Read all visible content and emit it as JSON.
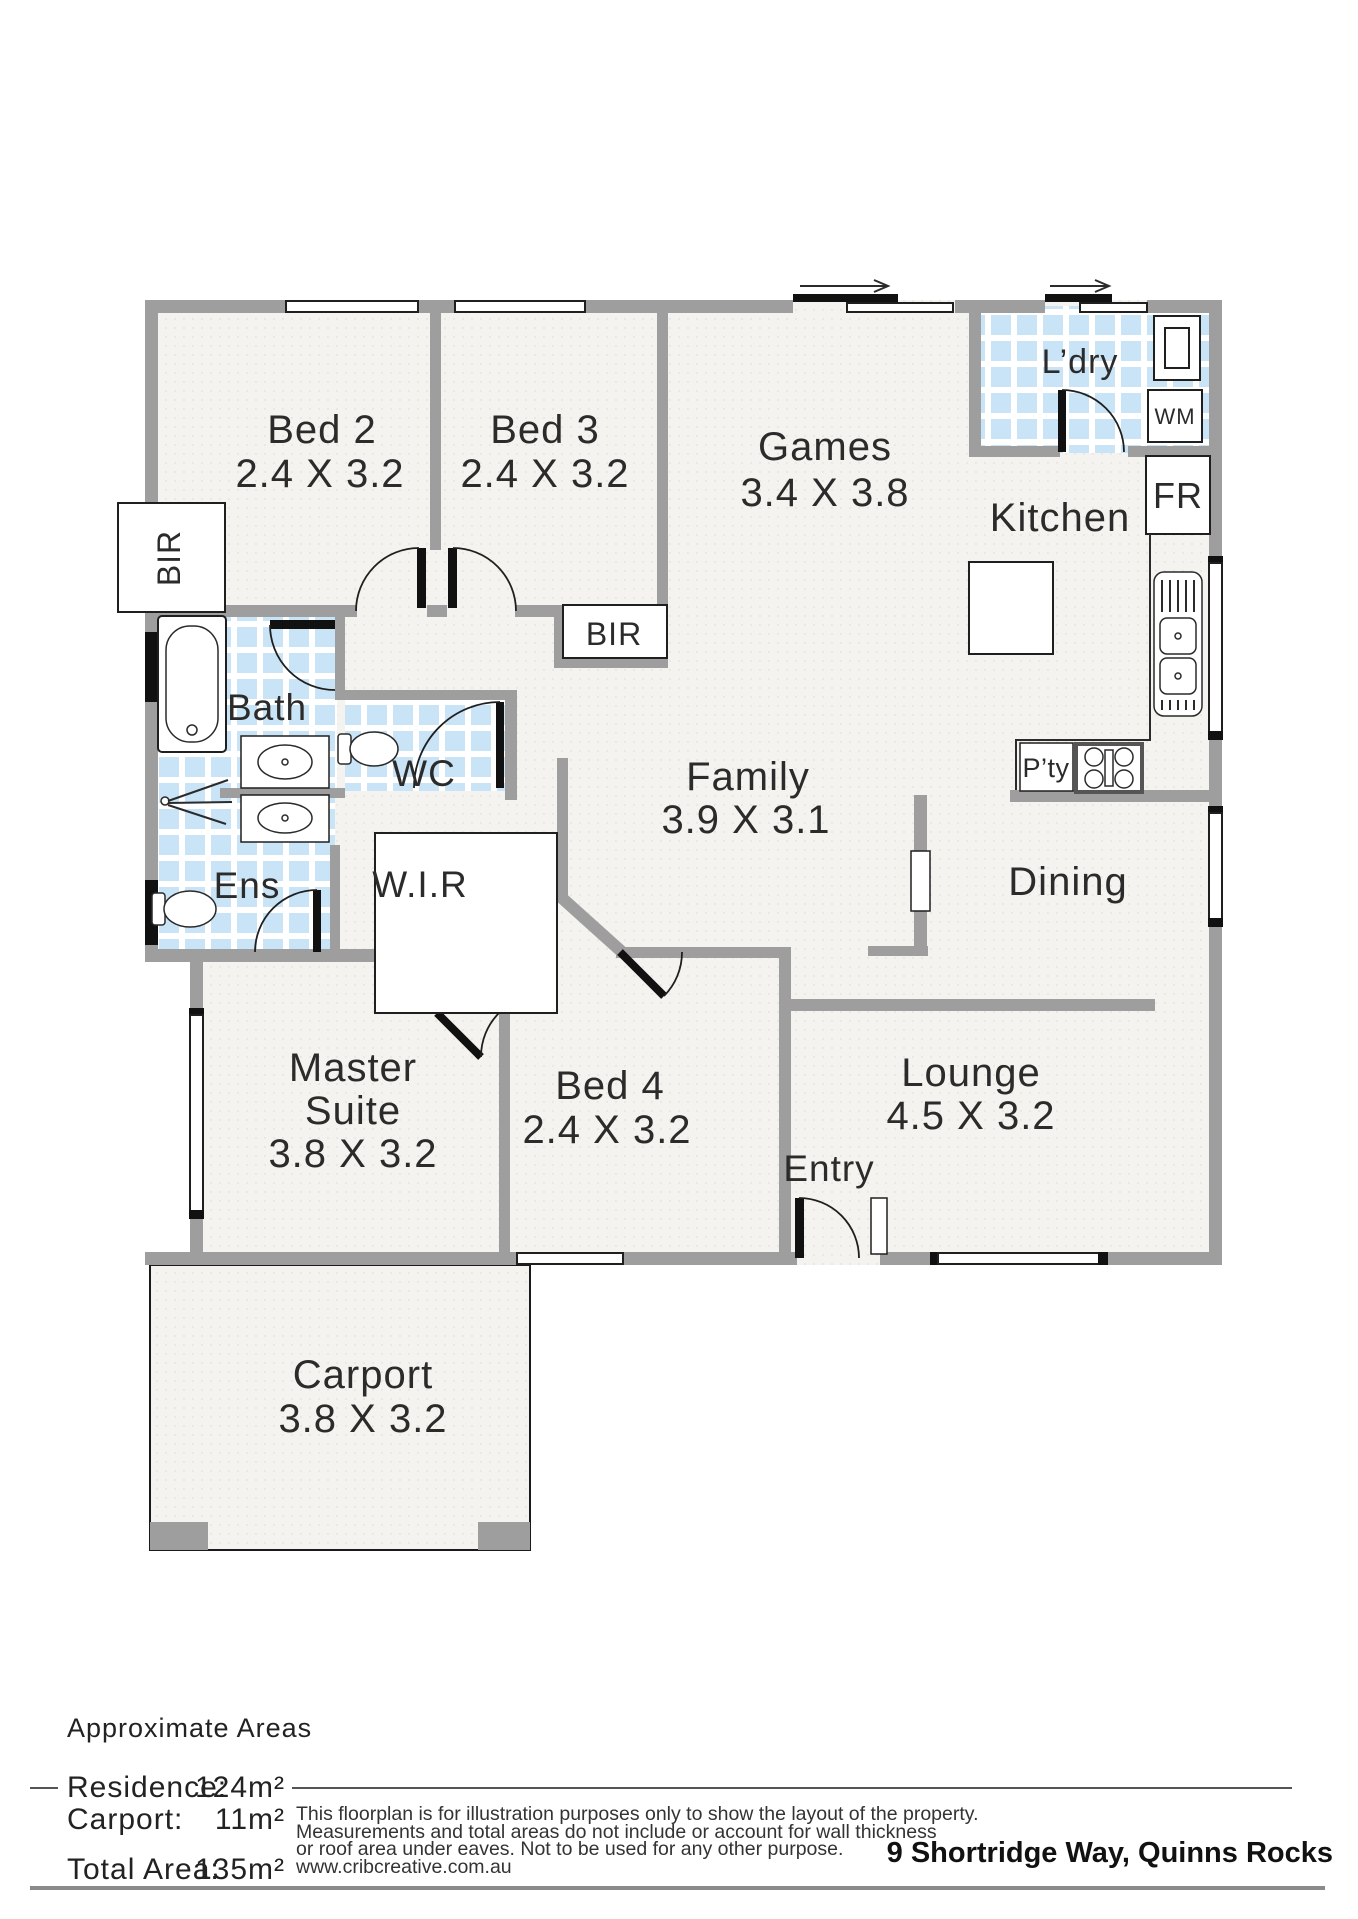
{
  "palette": {
    "wall_gray": "#9e9e9e",
    "tile_blue": "#c9e4f6",
    "floor": "#f4f3ef",
    "ink": "#2b2b2b"
  },
  "rooms": {
    "bed2": {
      "name": "Bed 2",
      "dims": "2.4 X 3.2"
    },
    "bed3": {
      "name": "Bed 3",
      "dims": "2.4 X 3.2"
    },
    "games": {
      "name": "Games",
      "dims": "3.4 X 3.8"
    },
    "laundry": {
      "name": "L’dry"
    },
    "kitchen": {
      "name": "Kitchen"
    },
    "family": {
      "name": "Family",
      "dims": "3.9 X 3.1"
    },
    "dining": {
      "name": "Dining"
    },
    "bath": {
      "name": "Bath"
    },
    "wc": {
      "name": "WC"
    },
    "ens": {
      "name": "Ens"
    },
    "wir": {
      "name": "W.I.R"
    },
    "master": {
      "name1": "Master",
      "name2": "Suite",
      "dims": "3.8 X 3.2"
    },
    "bed4": {
      "name": "Bed 4",
      "dims": "2.4 X 3.2"
    },
    "entry": {
      "name": "Entry"
    },
    "lounge": {
      "name": "Lounge",
      "dims": "4.5 X 3.2"
    },
    "carport": {
      "name": "Carport",
      "dims": "3.8 X 3.2"
    }
  },
  "fixtures": {
    "bir_bed2": "BIR",
    "bir_hall": "BIR",
    "wm": "WM",
    "fr": "FR",
    "pantry": "P’ty"
  },
  "footer": {
    "areas_heading": "Approximate Areas",
    "rows": [
      {
        "label": "Residence:",
        "value": "124m²"
      },
      {
        "label": "Carport:",
        "value": "11m²"
      },
      {
        "label": "Total Area:",
        "value": "135m²"
      }
    ],
    "disclaimer_lines": [
      "This floorplan is for illustration purposes only to show the layout of the property.",
      "Measurements and total areas do not include or account for wall thickness",
      "or roof area under eaves. Not to be used for any other purpose.",
      "www.cribcreative.com.au"
    ],
    "address": "9 Shortridge Way, Quinns Rocks"
  }
}
